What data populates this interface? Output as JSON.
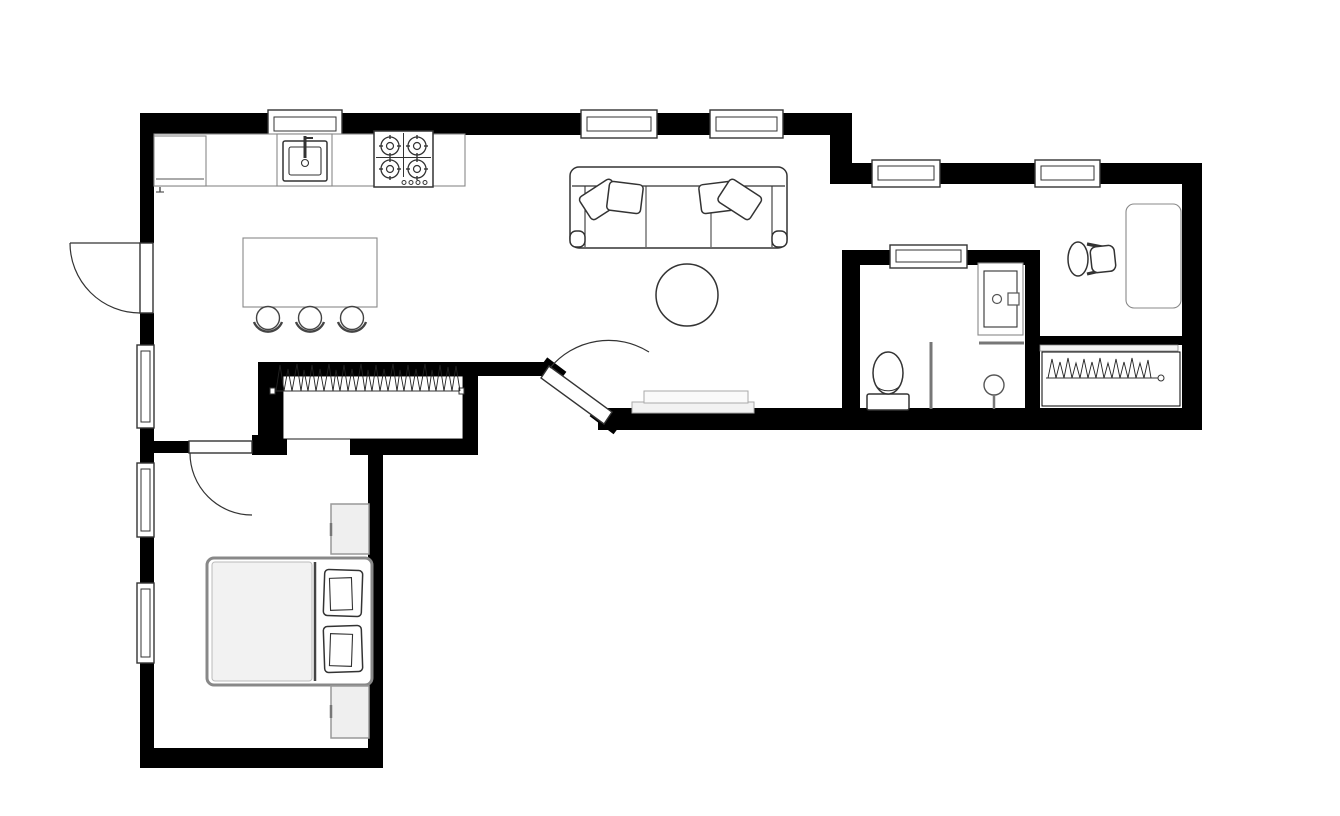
{
  "floor_plan": {
    "kind": "apartment-floor-plan",
    "style": "top-down black-and-white architectural drawing, no text labels",
    "colors": {
      "wall": "#000000",
      "background": "#ffffff",
      "furniture_outline": "#333333",
      "soft_outline": "#888888",
      "light_gray_fill": "#f2f2f2"
    },
    "rooms": [
      {
        "name": "kitchen",
        "position": "top-left",
        "items": [
          "refrigerator",
          "kitchen-counter",
          "kitchen-sink-with-faucet",
          "stove-4-burner",
          "kitchen-island",
          "bar-stool",
          "bar-stool",
          "bar-stool"
        ],
        "windows": 2,
        "doors": [
          "outward-swing-door-on-left-wall"
        ]
      },
      {
        "name": "living-room",
        "position": "top-center",
        "items": [
          "three-seat-sofa",
          "throw-pillow",
          "throw-pillow",
          "throw-pillow",
          "throw-pillow",
          "round-coffee-table",
          "tv-console"
        ],
        "windows": 2,
        "doors": [
          "diagonal-entry-door"
        ]
      },
      {
        "name": "hallway-closet",
        "position": "center",
        "items": [
          "hanging-rod-with-clothes"
        ]
      },
      {
        "name": "bathroom",
        "position": "right-of-center",
        "items": [
          "toilet",
          "vanity-sink-cabinet",
          "shower-partition",
          "shower-head"
        ],
        "windows": 1
      },
      {
        "name": "office-nook",
        "position": "top-right",
        "items": [
          "desk",
          "office-chair",
          "closet-sliding-track",
          "hanging-rod-with-clothes"
        ],
        "windows": 2
      },
      {
        "name": "bedroom",
        "position": "bottom-left",
        "items": [
          "double-bed",
          "bed-pillow",
          "bed-pillow",
          "nightstand",
          "nightstand"
        ],
        "windows": 2,
        "doors": [
          "inward-swing-door"
        ]
      }
    ],
    "counts": {
      "doors": 4,
      "windows": 9,
      "closet_rods": 2
    }
  }
}
